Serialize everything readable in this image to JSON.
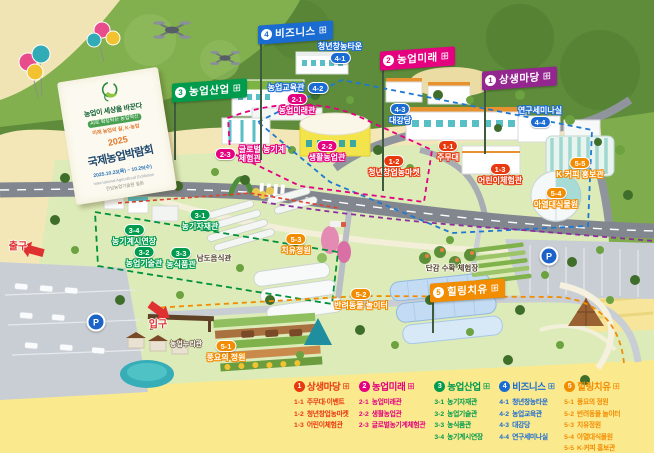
{
  "banner": {
    "slogan": "농업이 세상을 바꾼다",
    "sub1": "AI로 확장되는 농업혁신",
    "sub2": "미래 농업의 길, K-농업",
    "year": "2025",
    "title": "국제농업박람회",
    "date": "2025.10.23(목) ~ 10.29(수)",
    "subtitle_en": "International Agricultural Exhibition",
    "venue": "전남농업기술원 일원"
  },
  "flags": [
    {
      "num": "4",
      "label": "비즈니스",
      "color": "#1B6CD2",
      "x": 258,
      "y": 22,
      "pole": 130
    },
    {
      "num": "2",
      "label": "농업미래",
      "color": "#E4007F",
      "x": 380,
      "y": 48,
      "pole": 135
    },
    {
      "num": "1",
      "label": "상생마당",
      "color": "#93278F",
      "x": 482,
      "y": 68,
      "pole": 78
    },
    {
      "num": "3",
      "label": "농업산업",
      "color": "#009B4C",
      "x": 172,
      "y": 80,
      "pole": 72
    },
    {
      "num": "5",
      "label": "힐링치유",
      "color": "#F28C00",
      "x": 430,
      "y": 280,
      "pole": 45
    }
  ],
  "map_labels": [
    {
      "id": "4-1",
      "name": "청년창농타운",
      "color": "#1B6CD2",
      "x": 340,
      "y": 42,
      "layout": "col-rev"
    },
    {
      "id": "4-2",
      "name": "농업교육관",
      "color": "#1B6CD2",
      "x": 298,
      "y": 82,
      "layout": "row-rev"
    },
    {
      "id": "2-1",
      "name": "농업미래관",
      "color": "#E4007F",
      "x": 297,
      "y": 93,
      "layout": "col"
    },
    {
      "id": "4-3",
      "name": "대강당",
      "color": "#1B6CD2",
      "x": 400,
      "y": 103,
      "layout": "col"
    },
    {
      "id": "4-4",
      "name": "연구세미나실",
      "color": "#1B6CD2",
      "x": 540,
      "y": 106,
      "layout": "col-rev"
    },
    {
      "id": "2-3",
      "name": "글로벌 농기계\n체험관",
      "color": "#E4007F",
      "x": 250,
      "y": 145,
      "layout": "row"
    },
    {
      "id": "2-2",
      "name": "생활농업관",
      "color": "#E4007F",
      "x": 327,
      "y": 140,
      "layout": "col"
    },
    {
      "id": "1-1",
      "name": "주무대",
      "color": "#E8380D",
      "x": 448,
      "y": 140,
      "layout": "col"
    },
    {
      "id": "1-2",
      "name": "청년창업농마켓",
      "color": "#E8380D",
      "x": 394,
      "y": 155,
      "layout": "col"
    },
    {
      "id": "1-3",
      "name": "어린이체험관",
      "color": "#E8380D",
      "x": 500,
      "y": 163,
      "layout": "col"
    },
    {
      "id": "5-5",
      "name": "K-커피 홍보관",
      "color": "#F28C00",
      "x": 580,
      "y": 157,
      "layout": "col"
    },
    {
      "id": "5-4",
      "name": "아열대식물원",
      "color": "#F28C00",
      "x": 556,
      "y": 187,
      "layout": "col"
    },
    {
      "id": "3-1",
      "name": "농기자재관",
      "color": "#009B4C",
      "x": 200,
      "y": 209,
      "layout": "col"
    },
    {
      "id": "3-4",
      "name": "농기계시연장",
      "color": "#009B4C",
      "x": 134,
      "y": 224,
      "layout": "col"
    },
    {
      "id": "3-2",
      "name": "농업기술관",
      "color": "#009B4C",
      "x": 144,
      "y": 246,
      "layout": "col"
    },
    {
      "id": "3-3",
      "name": "농식품관",
      "color": "#009B4C",
      "x": 181,
      "y": 247,
      "layout": "col"
    },
    {
      "id": "5-3",
      "name": "치유정원",
      "color": "#F28C00",
      "x": 296,
      "y": 233,
      "layout": "col"
    },
    {
      "id": "5-2",
      "name": "반려동물 놀이터",
      "color": "#F28C00",
      "x": 361,
      "y": 288,
      "layout": "col"
    },
    {
      "id": "5-1",
      "name": "풍요의 정원",
      "color": "#F28C00",
      "x": 226,
      "y": 340,
      "layout": "col"
    }
  ],
  "plain_labels": [
    {
      "text": "단감 수확 체험장",
      "cls": "small-dark",
      "x": 452,
      "y": 268
    },
    {
      "text": "남도음식관",
      "cls": "small-dark",
      "x": 214,
      "y": 258
    },
    {
      "text": "농업누리관",
      "cls": "small-light",
      "x": 186,
      "y": 344
    },
    {
      "text": "입구",
      "cls": "gate",
      "x": 158,
      "y": 323
    },
    {
      "text": "출구",
      "cls": "gate",
      "x": 18,
      "y": 245
    }
  ],
  "parking": [
    {
      "label": "P",
      "x": 96,
      "y": 322
    },
    {
      "label": "P",
      "x": 549,
      "y": 256
    }
  ],
  "legend": {
    "hall_icon": "⊞",
    "categories": [
      {
        "num": "1",
        "title": "상생마당",
        "color": "#E8380D",
        "items": [
          {
            "id": "1-1",
            "name": "주무대·이벤트"
          },
          {
            "id": "1-2",
            "name": "청년창업농마켓"
          },
          {
            "id": "1-3",
            "name": "어린이체험관"
          }
        ]
      },
      {
        "num": "2",
        "title": "농업미래",
        "color": "#E4007F",
        "items": [
          {
            "id": "2-1",
            "name": "농업미래관"
          },
          {
            "id": "2-2",
            "name": "생활농업관"
          },
          {
            "id": "2-3",
            "name": "글로벌농기계체험관"
          }
        ]
      },
      {
        "num": "3",
        "title": "농업산업",
        "color": "#009B4C",
        "items": [
          {
            "id": "3-1",
            "name": "농기자재관"
          },
          {
            "id": "3-2",
            "name": "농업기술관"
          },
          {
            "id": "3-3",
            "name": "농식품관"
          },
          {
            "id": "3-4",
            "name": "농기계시연장"
          }
        ]
      },
      {
        "num": "4",
        "title": "비즈니스",
        "color": "#1B6CD2",
        "items": [
          {
            "id": "4-1",
            "name": "청년창농타운"
          },
          {
            "id": "4-2",
            "name": "농업교육관"
          },
          {
            "id": "4-3",
            "name": "대강당"
          },
          {
            "id": "4-4",
            "name": "연구세미나실"
          }
        ]
      },
      {
        "num": "5",
        "title": "힐링치유",
        "color": "#F28C00",
        "items": [
          {
            "id": "5-1",
            "name": "풍요의 정원"
          },
          {
            "id": "5-2",
            "name": "반려동물 놀이터"
          },
          {
            "id": "5-3",
            "name": "치유정원"
          },
          {
            "id": "5-4",
            "name": "아열대식물원"
          },
          {
            "id": "5-5",
            "name": "K-커피 홍보관"
          }
        ]
      }
    ]
  }
}
